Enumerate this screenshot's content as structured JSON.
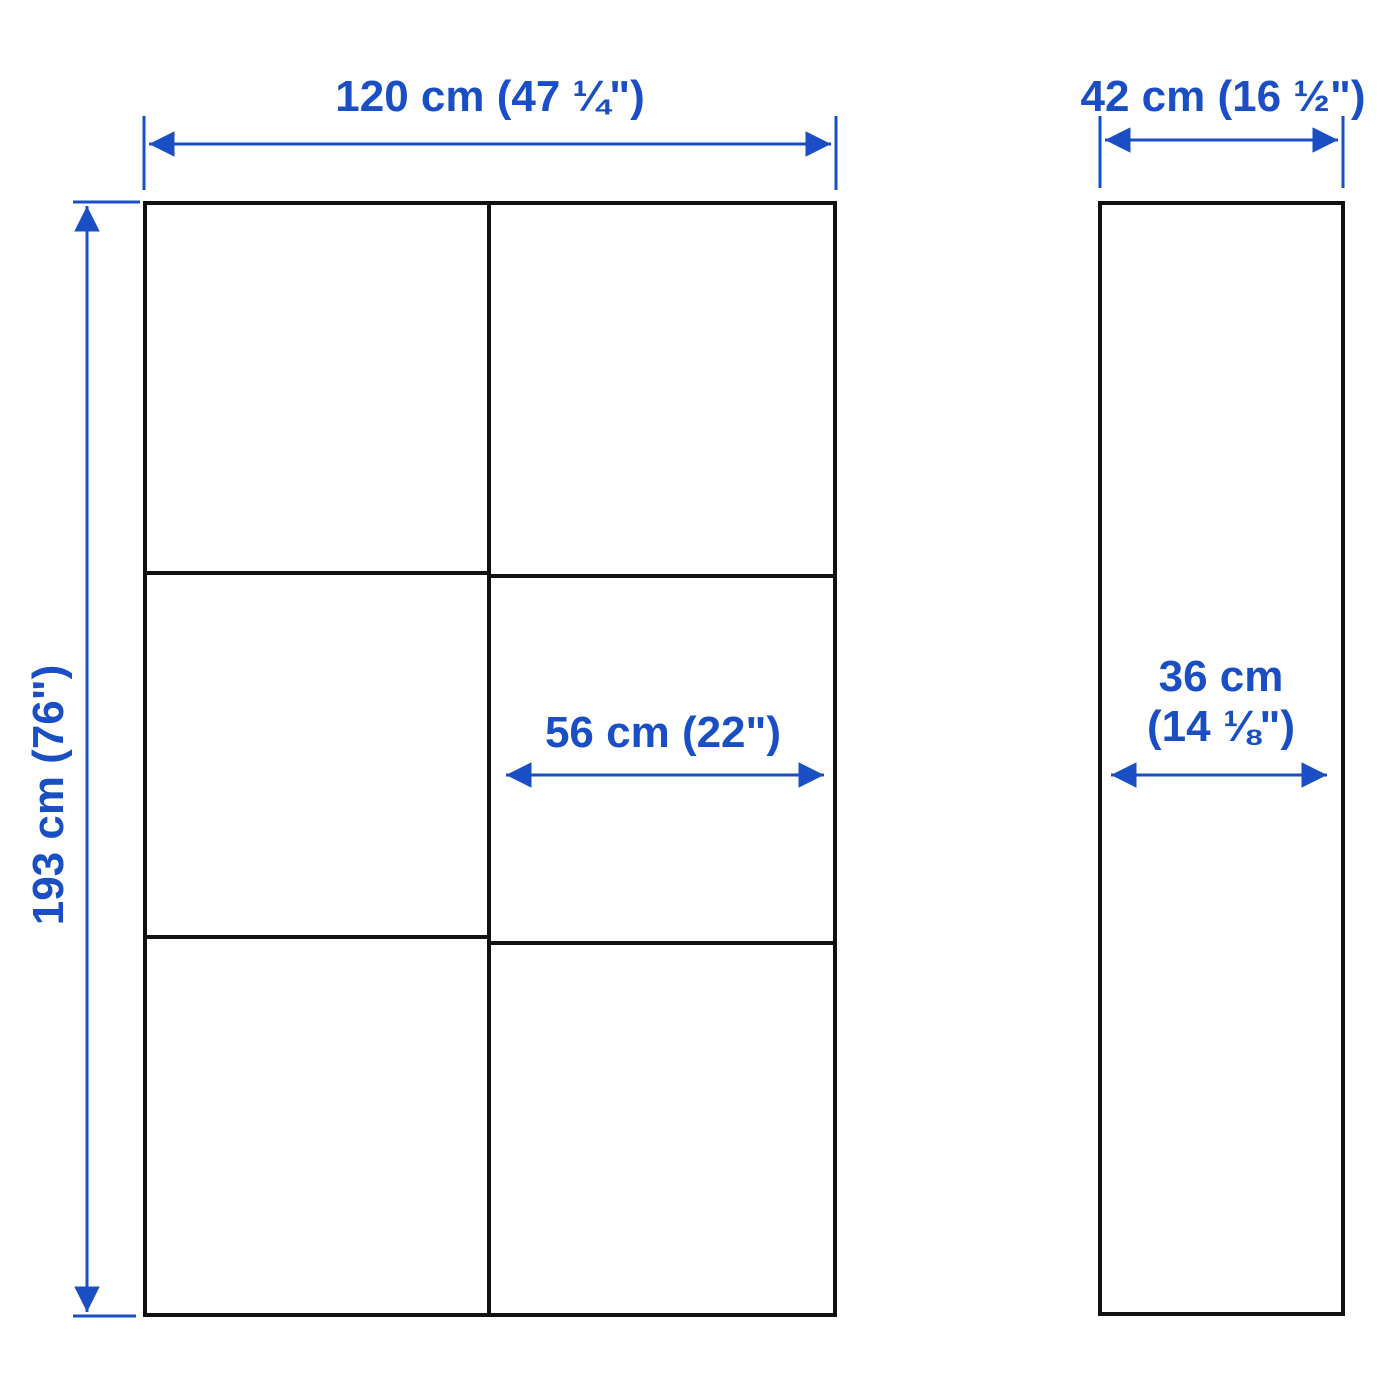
{
  "diagram": {
    "title": "cabinet-dimension-diagram",
    "front_view": {
      "width_label": "120 cm (47 ¼\")",
      "height_label": "193 cm (76\")",
      "door_width_label": "56 cm (22\")",
      "grid_columns": 2,
      "grid_rows": 3
    },
    "side_view": {
      "depth_label": "42 cm (16 ½\")",
      "inner_depth_label_line1": "36 cm",
      "inner_depth_label_line2": "(14 ⅛\")"
    },
    "colors": {
      "dimension": "#1A4EC4",
      "outline": "#111111",
      "background": "#FFFFFF"
    }
  }
}
